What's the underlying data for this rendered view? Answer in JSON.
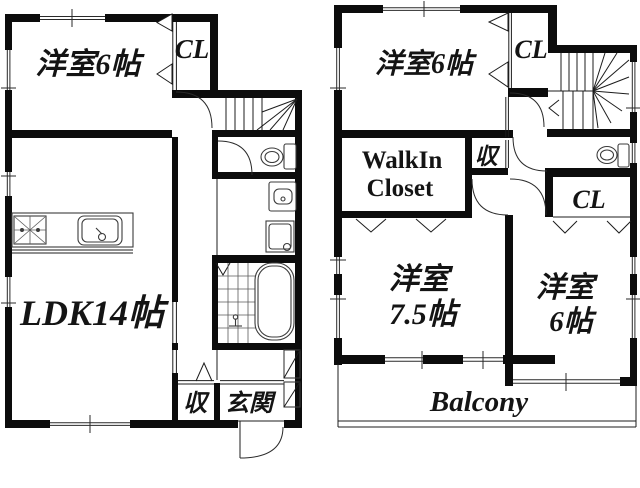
{
  "floor1": {
    "bedroom": "洋室6帖",
    "closet": "CL",
    "ldk": "LDK14帖",
    "storage": "収",
    "entrance": "玄関"
  },
  "floor2": {
    "bedroom_top": "洋室6帖",
    "closet_top": "CL",
    "wic_line1": "WalkIn",
    "wic_line2": "Closet",
    "storage": "収",
    "closet_bottom": "CL",
    "bedroom75_line1": "洋室",
    "bedroom75_line2": "7.5帖",
    "bedroom6_line1": "洋室",
    "bedroom6_line2": "6帖",
    "balcony": "Balcony"
  },
  "colors": {
    "wall": "#0c0c0c",
    "background": "#ffffff",
    "fixture_line": "#3b3b3b"
  }
}
